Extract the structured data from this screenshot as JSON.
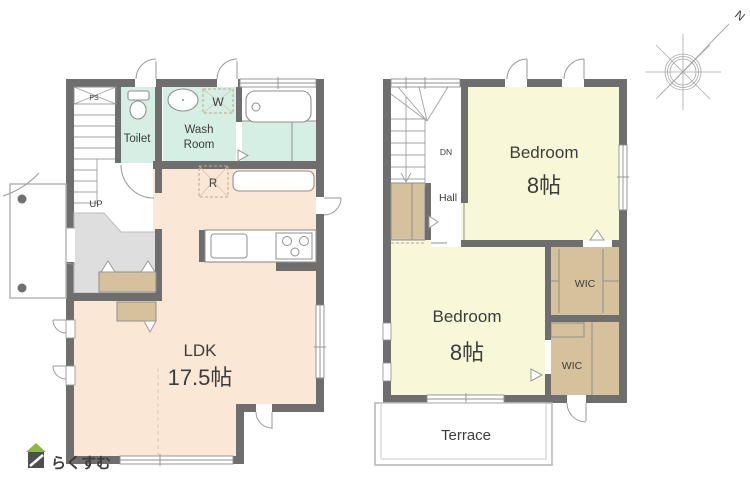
{
  "floor1": {
    "ldk_label": "LDK",
    "ldk_size": "17.5帖",
    "toilet_label": "Toilet",
    "washroom_line1": "Wash",
    "washroom_line2": "Room",
    "washer_label": "W",
    "fridge_label": "R",
    "ps_label": "PS",
    "up_label": "UP"
  },
  "floor2": {
    "bedroom1_label": "Bedroom",
    "bedroom1_size": "8帖",
    "bedroom2_label": "Bedroom",
    "bedroom2_size": "8帖",
    "wic1_label": "WIC",
    "wic2_label": "WIC",
    "dn_label": "DN",
    "hall_label": "Hall",
    "terrace_label": "Terrace"
  },
  "compass": {
    "north_label": "N"
  },
  "logo": {
    "brand_text": "らくすむ"
  },
  "colors": {
    "wall": "#6e6e6e",
    "ldk": "#fbe7d5",
    "wet": "#d5efe5",
    "bedroom": "#f8f8d8",
    "storage": "#d5c19c",
    "genkan": "#dedede",
    "white": "#ffffff",
    "logo_green": "#8cb843",
    "logo_gray": "#4e4e4e",
    "logo_text": "#b49a7c"
  }
}
